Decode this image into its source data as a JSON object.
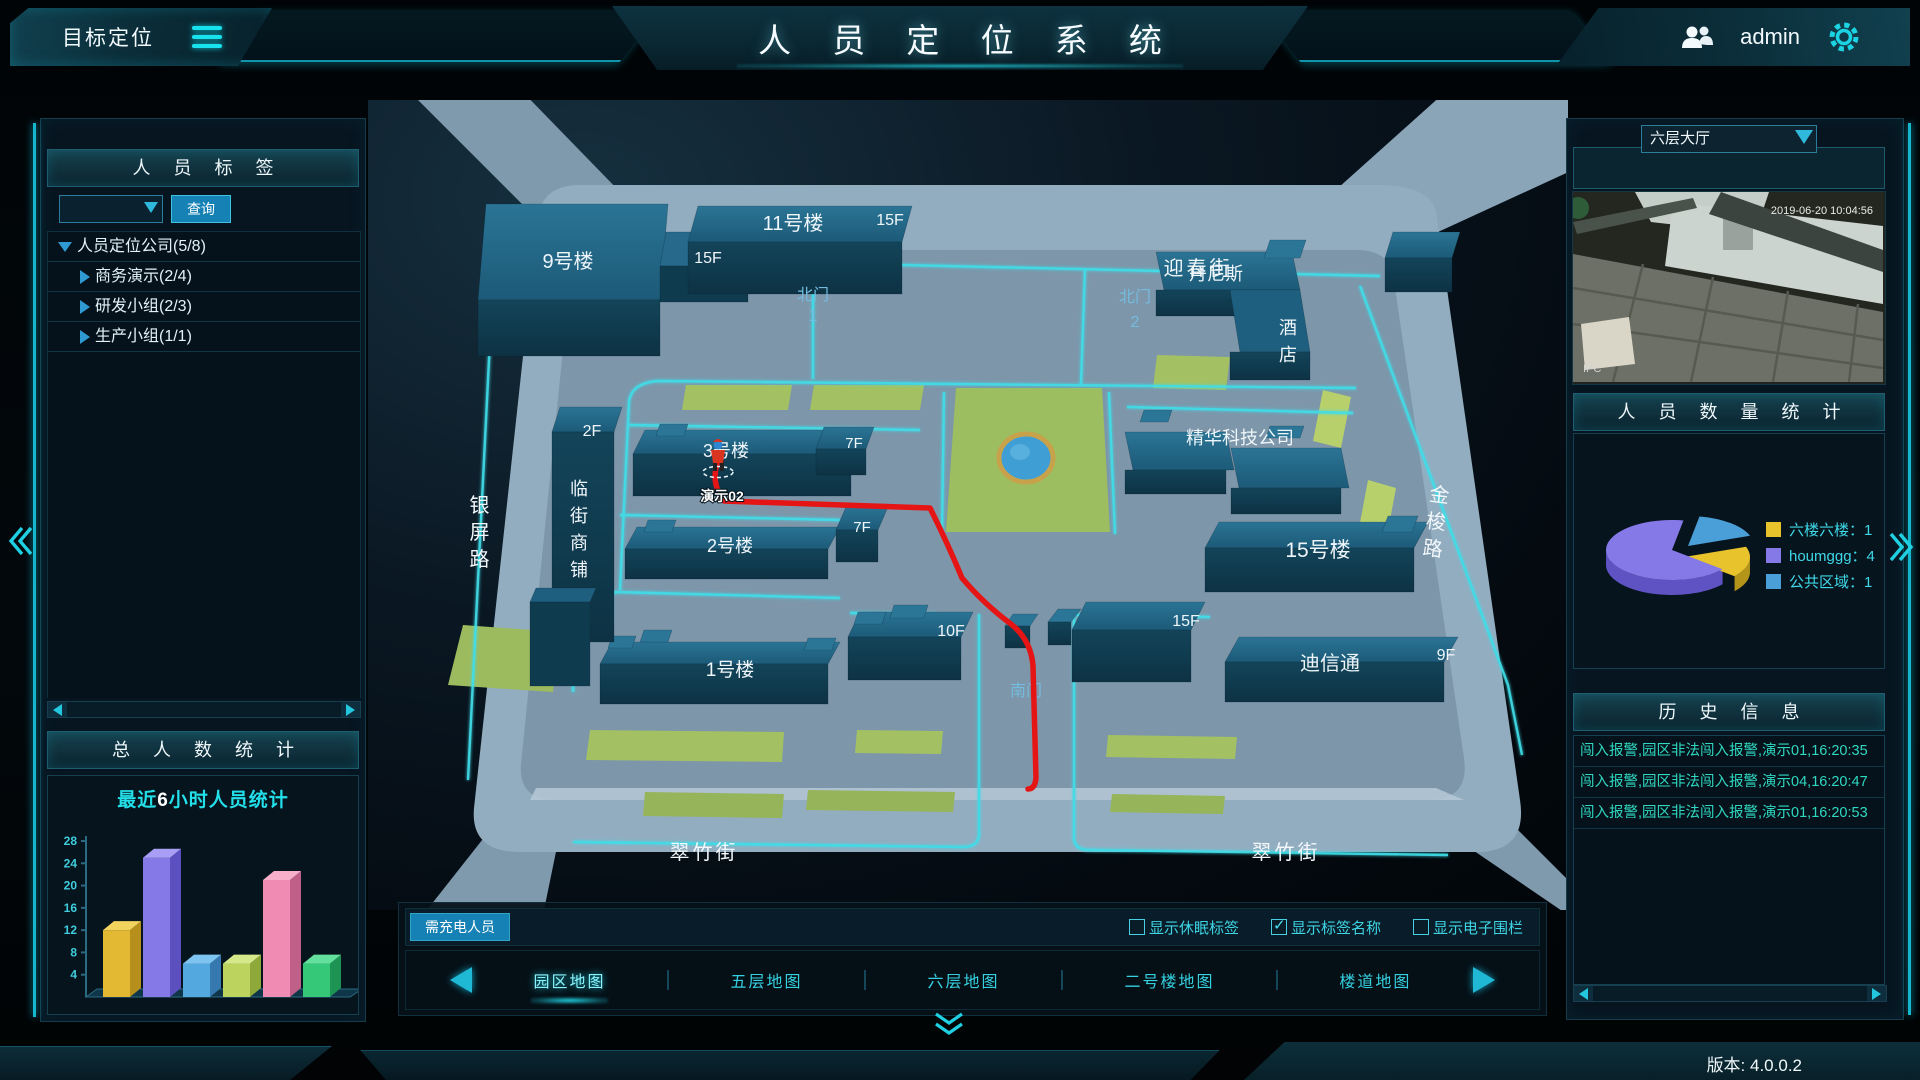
{
  "header": {
    "app_title": "目标定位",
    "system_title": "人 员 定 位 系 统",
    "username": "admin"
  },
  "icons": {
    "menu": "hamburger-icon",
    "user": "users-icon",
    "settings": "gear-icon",
    "dropdown": "chevron-down-icon",
    "collapse_left": "double-chevron-left-icon",
    "collapse_right": "double-chevron-right-icon",
    "collapse_down": "double-chevron-down-icon"
  },
  "colors": {
    "accent": "#1bd3e2",
    "button": "#1581b4",
    "alarm_text": "#2fd8c0",
    "map_path": "#e51515",
    "map_road_line": "#3fdde8"
  },
  "left_panel": {
    "tags_header": "人 员 标 签",
    "search": {
      "dropdown_value": "",
      "button_label": "查询"
    },
    "tree": [
      {
        "label": "人员定位公司(5/8)",
        "state": "expanded"
      },
      {
        "label": "商务演示(2/4)",
        "state": "collapsed"
      },
      {
        "label": "研发小组(2/3)",
        "state": "collapsed"
      },
      {
        "label": "生产小组(1/1)",
        "state": "collapsed"
      }
    ],
    "total_header": "总 人 数 统 计"
  },
  "chart_data": [
    {
      "type": "bar",
      "title": "最近6小时人员统计",
      "title_segments": {
        "prefix": "最近",
        "number": "6",
        "suffix": "小时人员统计"
      },
      "values": [
        12,
        25,
        6,
        6,
        21,
        6
      ],
      "ylim": [
        0,
        28
      ],
      "yticks": [
        4,
        8,
        12,
        16,
        20,
        24,
        28
      ],
      "x_tick_labels_visible": false,
      "style": "3d",
      "bar_colors": [
        {
          "base": "#e3b832",
          "light": "#f2d35e",
          "dark": "#b78f1d"
        },
        {
          "base": "#8579e8",
          "light": "#a89ef5",
          "dark": "#5c50c0"
        },
        {
          "base": "#54a8e0",
          "light": "#7ec4f0",
          "dark": "#3579b0"
        },
        {
          "base": "#bcd45e",
          "light": "#d5e88a",
          "dark": "#8fa83a"
        },
        {
          "base": "#f08cb4",
          "light": "#f8afc9",
          "dark": "#c05f88"
        },
        {
          "base": "#35c878",
          "light": "#63e09d",
          "dark": "#1e9454"
        }
      ]
    },
    {
      "type": "pie",
      "title": "人 员 数 量 统 计",
      "series": [
        {
          "label": "六楼六楼",
          "value": 1,
          "color": "#e8c32c",
          "dark": "#b5941a"
        },
        {
          "label": "houmggg",
          "value": 4,
          "color": "#8579e8",
          "dark": "#5f53c4"
        },
        {
          "label": "公共区域",
          "value": 1,
          "color": "#4a9fd8",
          "dark": "#31719f"
        }
      ],
      "legend_position": "right",
      "style": "3d-exploded"
    }
  ],
  "map": {
    "buildings": {
      "b9": "9号楼",
      "b9_floor": "15F",
      "b11": "11号楼",
      "b11_floor": "15F",
      "hotel_line1": "丹尼斯",
      "hotel_line2": "酒店",
      "jinghua": "精华科技公司",
      "b15": "15号楼",
      "center_floor": "15F",
      "dixintong": "迪信通",
      "dixintong_floor": "9F",
      "b10_floor": "10F",
      "b1": "1号楼",
      "b2": "2号楼",
      "b2_floor": "7F",
      "b3": "3号楼",
      "b3_floor": "7F",
      "shop_floor": "2F",
      "shop": "临街商铺"
    },
    "streets": {
      "yingchun": "迎春街",
      "cuizhu_left": "翠竹街",
      "cuizhu_right": "翠竹街",
      "yinping": "银屏路",
      "jinsuo": "金梭路"
    },
    "gates": {
      "north1_label": "北门",
      "north1_num": "1",
      "north2_label": "北门",
      "north2_num": "2",
      "south": "南门"
    },
    "person_tag": "演示02"
  },
  "bottom_bar": {
    "charge_button": "需充电人员",
    "checkboxes": [
      {
        "label": "显示休眠标签",
        "checked": false
      },
      {
        "label": "显示标签名称",
        "checked": true
      },
      {
        "label": "显示电子围栏",
        "checked": false
      }
    ],
    "tabs": [
      {
        "label": "园区地图",
        "active": true
      },
      {
        "label": "五层地图",
        "active": false
      },
      {
        "label": "六层地图",
        "active": false
      },
      {
        "label": "二号楼地图",
        "active": false
      },
      {
        "label": "楼道地图",
        "active": false
      }
    ]
  },
  "right_panel": {
    "camera_select": "六层大厅",
    "camera_timestamp": "2019-06-20 10:04:56",
    "camera_watermark": "IPC",
    "count_header": "人 员 数 量 统 计",
    "history_header": "历 史 信 息",
    "history": [
      "闯入报警,园区非法闯入报警,演示01,16:20:35",
      "闯入报警,园区非法闯入报警,演示04,16:20:47",
      "闯入报警,园区非法闯入报警,演示01,16:20:53"
    ]
  },
  "footer": {
    "version": "版本: 4.0.0.2"
  }
}
